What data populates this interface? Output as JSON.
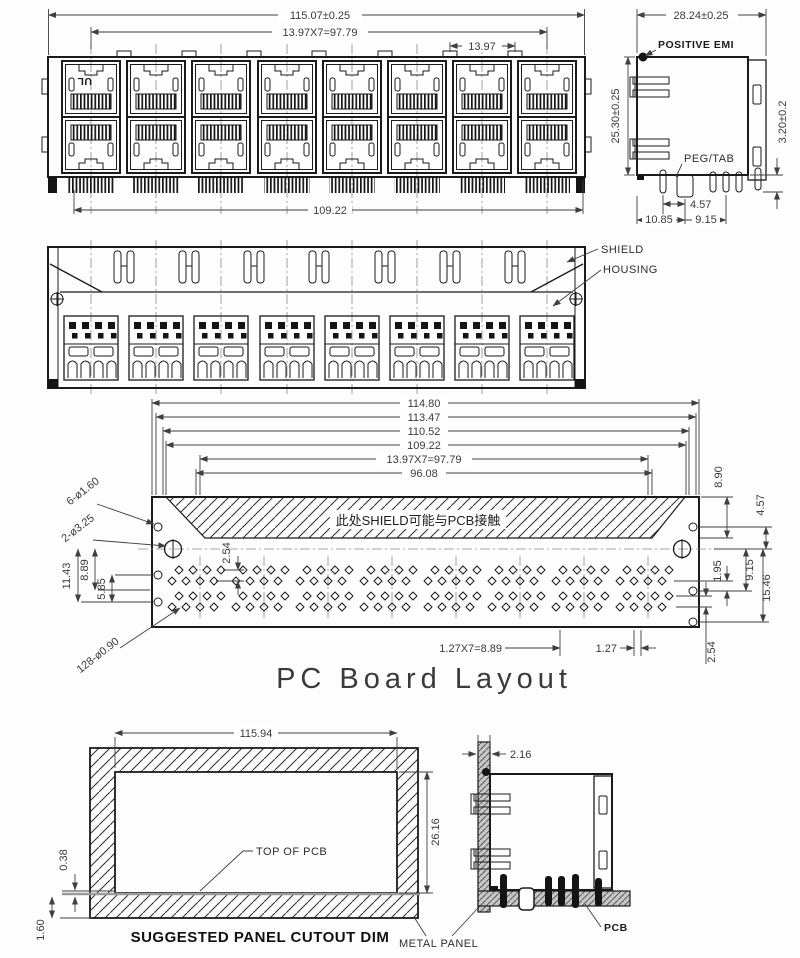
{
  "drawing": {
    "front_view": {
      "dim_overall": "115.07±0.25",
      "dim_pitch_total": "13.97X7=97.79",
      "dim_pitch": "13.97",
      "dim_shield": "109.22",
      "ul_mark": "UL"
    },
    "side_view": {
      "dim_depth": "28.24±0.25",
      "dim_height": "25.30±0.25",
      "dim_standoff": "3.20±0.2",
      "dim_peg_offset": "4.57",
      "dim_front_offset": "10.85",
      "dim_row_offset": "9.15",
      "label_emi": "POSITIVE EMI",
      "label_peg": "PEG/TAB"
    },
    "rear_view": {
      "label_shield": "SHIELD",
      "label_housing": "HOUSING"
    },
    "pcb_layout": {
      "title": "PC Board Layout",
      "dim_1": "114.80",
      "dim_2": "113.47",
      "dim_3": "110.52",
      "dim_4": "109.22",
      "dim_5": "13.97X7=97.79",
      "dim_6": "96.08",
      "hole_small_label": "6-ø1.60",
      "hole_big_label": "2-ø3.25",
      "hole_pin_label": "128-ø0.90",
      "note_cn": "此处SHIELD可能与PCB接触",
      "dim_hatch_depth": "8.90",
      "dim_hole_gap": "4.57",
      "dim_row_gap": "1.95",
      "dim_row2": "9.15",
      "dim_row3": "15.46",
      "dim_left_1": "11.43",
      "dim_left_2": "8.89",
      "dim_left_3": "5.85",
      "dim_pin_row_pitch": "2.54",
      "dim_pin_pitch_total": "1.27X7=8.89",
      "dim_pin_pitch": "1.27",
      "dim_bottom_edge": "2.54"
    },
    "panel_cutout": {
      "caption": "SUGGESTED PANEL CUTOUT DIM",
      "dim_width": "115.94",
      "dim_height": "26.16",
      "dim_pcb_gap": "0.38",
      "dim_panel_thk": "1.60",
      "label_pcb_top": "TOP OF PCB",
      "label_panel": "METAL PANEL"
    },
    "panel_side": {
      "dim_thickness": "2.16",
      "label_pcb": "PCB"
    },
    "colors": {
      "line": "#1b1b1b",
      "dim": "#3f3f3f",
      "background": "#fdfdfd"
    }
  }
}
